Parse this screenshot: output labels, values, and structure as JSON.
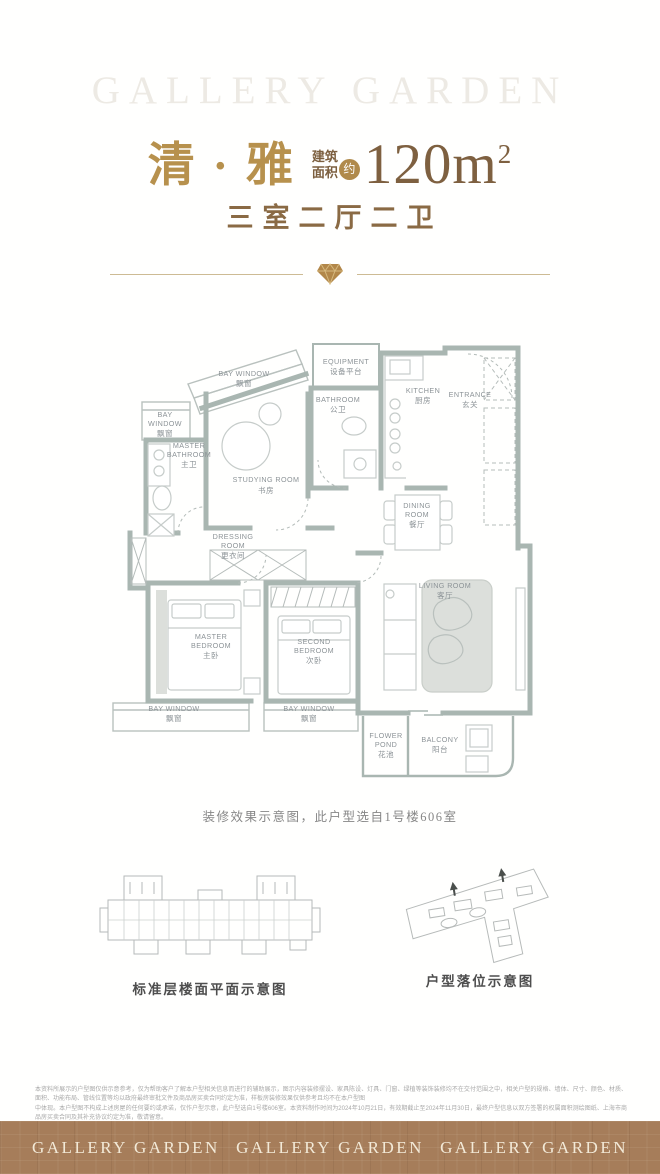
{
  "watermark": "GALLERY GARDEN",
  "header": {
    "title": "清 · 雅",
    "area_label_line1": "建筑",
    "area_label_line2": "面积",
    "area_badge": "约",
    "area_value": "120m",
    "area_exponent": "2",
    "layout_type": "三室二厅二卫"
  },
  "floorplan": {
    "caption": "装修效果示意图，此户型选自1号楼606室",
    "rooms": {
      "bay_top": [
        "BAY WINDOW",
        "飘窗"
      ],
      "bay_left": [
        "BAY",
        "WINDOW",
        "飘窗"
      ],
      "master_bath": [
        "MASTER",
        "BATHROOM",
        "主卫"
      ],
      "study": [
        "STUDYING ROOM",
        "书房"
      ],
      "equipment": [
        "EQUIPMENT",
        "设备平台"
      ],
      "bathroom": [
        "BATHROOM",
        "公卫"
      ],
      "kitchen": [
        "KITCHEN",
        "厨房"
      ],
      "entrance": [
        "ENTRANCE",
        "玄关"
      ],
      "dining": [
        "DINING",
        "ROOM",
        "餐厅"
      ],
      "dressing": [
        "DRESSING",
        "ROOM",
        "更衣间"
      ],
      "master_bed": [
        "MASTER",
        "BEDROOM",
        "主卧"
      ],
      "second_bed": [
        "SECOND",
        "BEDROOM",
        "次卧"
      ],
      "living": [
        "LIVING ROOM",
        "客厅"
      ],
      "bay_bl": [
        "BAY WINDOW",
        "飘窗"
      ],
      "bay_bm": [
        "BAY WINDOW",
        "飘窗"
      ],
      "flower_pond": [
        "FLOWER",
        "POND",
        "花池"
      ],
      "balcony": [
        "BALCONY",
        "阳台"
      ]
    }
  },
  "diagrams": {
    "floor_plate_caption": "标准层楼面平面示意图",
    "site_caption": "户型落位示意图"
  },
  "disclaimer": {
    "line1": "本资料所展示的户型图仅供示意参考，仅为帮助客户了解本户型相关信息而进行的辅助展示，图示内容装修摆设、家具陈设、灯具、门窗、绿植等装饰装修均不在交付范围之中，相关户型的规格、墙体、尺寸、颜色、材质、面积、功能布局、管线位置等均以政府最终审批文件及商品房买卖合同约定为准，样板房装修效果仅供参考且均不在本户型图",
    "line2": "中体现。本户型图不构成上述房屋的任何要约或承诺，仅作户型示意，此户型选自1号楼606室。本资料制作时间为2024年10月21日，有效期截止至2024年11月30日，最终户型信息以双方签署的权属面积测绘图纸、上海市商品房买卖合同及其补充协议约定为准，敬请留意。"
  },
  "footer": {
    "brand": "GALLERY GARDEN"
  },
  "colors": {
    "gold": "#b7914d",
    "brown_text": "#8a6a44",
    "wall": "#a9b6b1",
    "footer_bg": "#a67d5a",
    "footer_text": "#f2e9d7"
  }
}
